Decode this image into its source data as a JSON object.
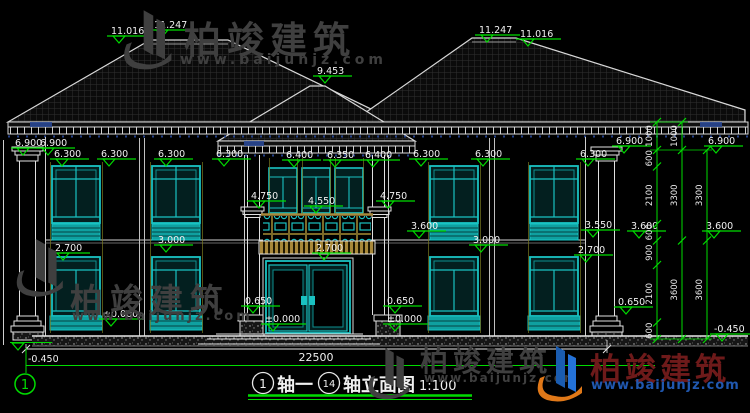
{
  "watermark": {
    "brand": "柏竣建筑",
    "url": "www.baijunjz.com"
  },
  "drawing": {
    "title": {
      "axis_start_no": "1",
      "axis_start": "轴一",
      "axis_end_no": "14",
      "axis_end": "轴立面图",
      "scale": "1:100"
    },
    "axis_bubble": "1",
    "total_width_mm": "22500",
    "elevation_marks": [
      {
        "label": "11.016",
        "x": 111,
        "y": 25
      },
      {
        "label": "11.247",
        "x": 154,
        "y": 19
      },
      {
        "label": "11.247",
        "x": 479,
        "y": 24
      },
      {
        "label": "11.016",
        "x": 520,
        "y": 28
      },
      {
        "label": "9.453",
        "x": 317,
        "y": 65
      },
      {
        "label": "6.900",
        "x": 15,
        "y": 137
      },
      {
        "label": "6.900",
        "x": 40,
        "y": 137
      },
      {
        "label": "6.900",
        "x": 616,
        "y": 135
      },
      {
        "label": "6.900",
        "x": 708,
        "y": 135
      },
      {
        "label": "6.300",
        "x": 54,
        "y": 148
      },
      {
        "label": "6.300",
        "x": 101,
        "y": 148
      },
      {
        "label": "6.300",
        "x": 158,
        "y": 148
      },
      {
        "label": "6.300",
        "x": 216,
        "y": 148
      },
      {
        "label": "6.400",
        "x": 286,
        "y": 149
      },
      {
        "label": "6.350",
        "x": 327,
        "y": 149
      },
      {
        "label": "6.400",
        "x": 365,
        "y": 149
      },
      {
        "label": "6.300",
        "x": 413,
        "y": 148
      },
      {
        "label": "6.300",
        "x": 475,
        "y": 148
      },
      {
        "label": "6.300",
        "x": 580,
        "y": 148
      },
      {
        "label": "4.750",
        "x": 251,
        "y": 190
      },
      {
        "label": "4.550",
        "x": 308,
        "y": 195
      },
      {
        "label": "4.750",
        "x": 380,
        "y": 190
      },
      {
        "label": "3.600",
        "x": 411,
        "y": 220
      },
      {
        "label": "3.550",
        "x": 585,
        "y": 219
      },
      {
        "label": "3.600",
        "x": 631,
        "y": 220
      },
      {
        "label": "3.600",
        "x": 706,
        "y": 220
      },
      {
        "label": "3.000",
        "x": 158,
        "y": 234
      },
      {
        "label": "3.000",
        "x": 473,
        "y": 234
      },
      {
        "label": "2.700",
        "x": 55,
        "y": 242
      },
      {
        "label": "2.700",
        "x": 316,
        "y": 242
      },
      {
        "label": "2.700",
        "x": 578,
        "y": 244
      },
      {
        "label": "0.650",
        "x": 245,
        "y": 295
      },
      {
        "label": "0.650",
        "x": 387,
        "y": 295
      },
      {
        "label": "0.650",
        "x": 618,
        "y": 296
      },
      {
        "label": "±0.000",
        "x": 103,
        "y": 308
      },
      {
        "label": "±0.000",
        "x": 265,
        "y": 313
      },
      {
        "label": "±0.000",
        "x": 387,
        "y": 313
      },
      {
        "label": "-0.450",
        "x": 714,
        "y": 323
      }
    ],
    "mark_minus_left": {
      "label": "-0.450"
    },
    "dim_chains": [
      {
        "labels": [
          "1000",
          "600",
          "2100",
          "600",
          "900",
          "2100",
          "600"
        ]
      },
      {
        "labels": [
          "1000",
          "3300",
          "3600"
        ]
      },
      {
        "labels": [
          "3300",
          "3600"
        ]
      }
    ],
    "colors": {
      "accent_green": "#00dc00",
      "cad_teal": "#1ac2c2",
      "cad_white": "#e8e8e8",
      "gold": "#b4923e",
      "navy": "#2a4a9a"
    }
  }
}
